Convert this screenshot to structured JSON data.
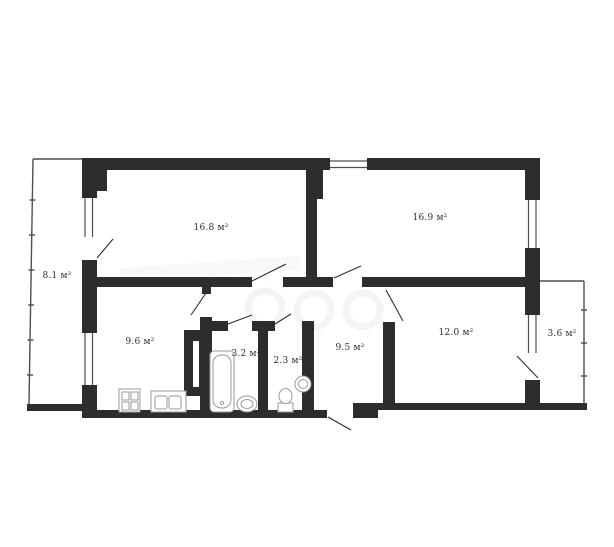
{
  "floor_plan": {
    "type": "apartment-floor-plan",
    "area_unit": "м²",
    "wall_color": "#2d2d2d",
    "line_color": "#4f4f4f",
    "fixture_color": "#9a9a9a",
    "label_color": "#2f2f2f",
    "rooms": [
      {
        "name": "balcony-left",
        "area_label": "8.1 м²"
      },
      {
        "name": "room-16-8",
        "area_label": "16.8 м²"
      },
      {
        "name": "room-16-9",
        "area_label": "16.9 м²"
      },
      {
        "name": "kitchen",
        "area_label": "9.6 м²"
      },
      {
        "name": "bathroom",
        "area_label": "3.2 м²"
      },
      {
        "name": "toilet",
        "area_label": "2.3 м²"
      },
      {
        "name": "hallway",
        "area_label": "9.5 м²"
      },
      {
        "name": "room-12-0",
        "area_label": "12.0 м²"
      },
      {
        "name": "balcony-right",
        "area_label": "3.6 м²"
      }
    ]
  }
}
